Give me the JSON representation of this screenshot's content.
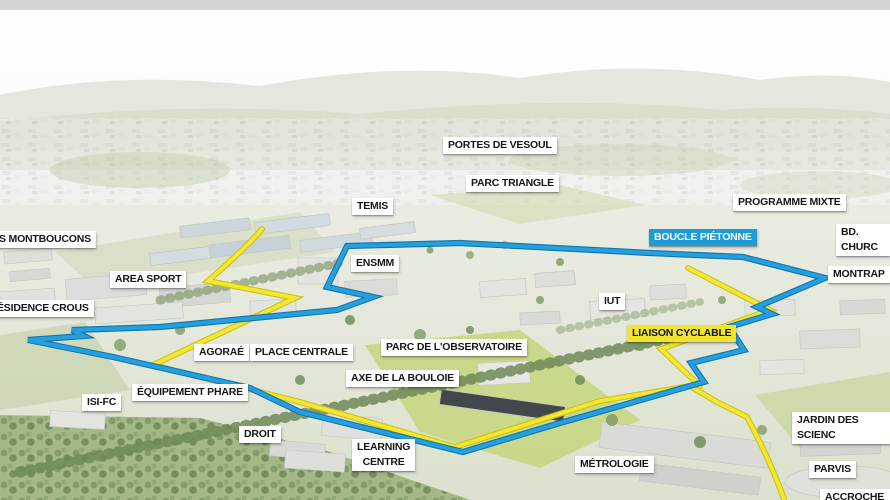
{
  "map": {
    "type": "campus-masterplan-aerial-view",
    "routes": [
      {
        "id": "boucle-pietonne",
        "label": "BOUCLE PIÉTONNE",
        "color": "#259fdd",
        "casing": "#1376ab",
        "badge_bg": "#1e9cd8",
        "badge_text_color": "#ffffff"
      },
      {
        "id": "liaison-cyclable",
        "label": "LIAISON CYCLABLE",
        "color": "#f2e732",
        "casing": "#cfc016",
        "badge_bg": "#f0e42e",
        "badge_text_color": "#131313"
      }
    ],
    "labels": [
      {
        "id": "portes-de-vesoul",
        "text": "PORTES DE VESOUL"
      },
      {
        "id": "parc-triangle",
        "text": "PARC TRIANGLE"
      },
      {
        "id": "temis",
        "text": "TEMIS"
      },
      {
        "id": "programme-mixte",
        "text": "PROGRAMME MIXTE"
      },
      {
        "id": "bd-churchill",
        "text": "BD. CHURC"
      },
      {
        "id": "montrapon",
        "text": "MONTRAP"
      },
      {
        "id": "les-montboucons",
        "text": "S MONTBOUCONS"
      },
      {
        "id": "area-sport",
        "text": "AREA SPORT"
      },
      {
        "id": "ensmm",
        "text": "ENSMM"
      },
      {
        "id": "residence-crous",
        "text": "ÉSIDENCE CROUS"
      },
      {
        "id": "iut",
        "text": "IUT"
      },
      {
        "id": "agorae",
        "text": "AGORAÉ"
      },
      {
        "id": "place-centrale",
        "text": "PLACE CENTRALE"
      },
      {
        "id": "parc-observatoire",
        "text": "PARC DE L'OBSERVATOIRE"
      },
      {
        "id": "axe-bouloie",
        "text": "AXE DE LA BOULOIE"
      },
      {
        "id": "equipement-phare",
        "text": "ÉQUIPEMENT PHARE"
      },
      {
        "id": "isi-fc",
        "text": "ISI-FC"
      },
      {
        "id": "droit",
        "text": "DROIT"
      },
      {
        "id": "learning-centre",
        "text": "LEARNING\nCENTRE"
      },
      {
        "id": "metrologie",
        "text": "MÉTROLOGIE"
      },
      {
        "id": "jardin-des-sciences",
        "text": "JARDIN DES SCIENC"
      },
      {
        "id": "parvis",
        "text": "PARVIS"
      },
      {
        "id": "accroche",
        "text": "ACCROCHE S"
      }
    ]
  }
}
